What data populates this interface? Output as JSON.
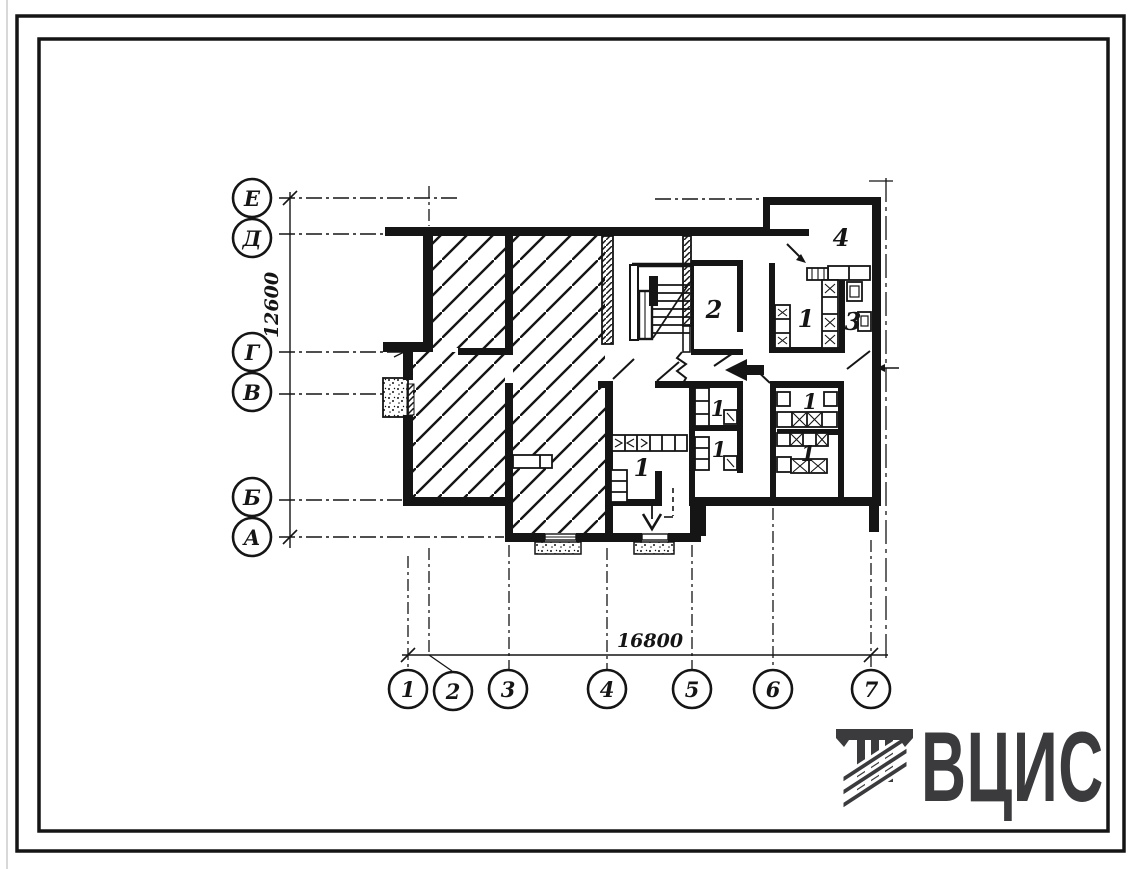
{
  "axes": {
    "rows": [
      "Е",
      "Д",
      "Г",
      "В",
      "Б",
      "А"
    ],
    "cols": [
      "1",
      "2",
      "3",
      "4",
      "5",
      "6",
      "7"
    ]
  },
  "dimensions": {
    "horizontal": "16800",
    "vertical": "12600"
  },
  "room_labels": [
    "4",
    "2",
    "1",
    "3",
    "1",
    "1",
    "1",
    "1",
    "1"
  ],
  "logo": {
    "text": "ВЦИС"
  },
  "colors": {
    "ink": "#151515",
    "logo": "#3b3b3e",
    "paper": "#ffffff"
  }
}
